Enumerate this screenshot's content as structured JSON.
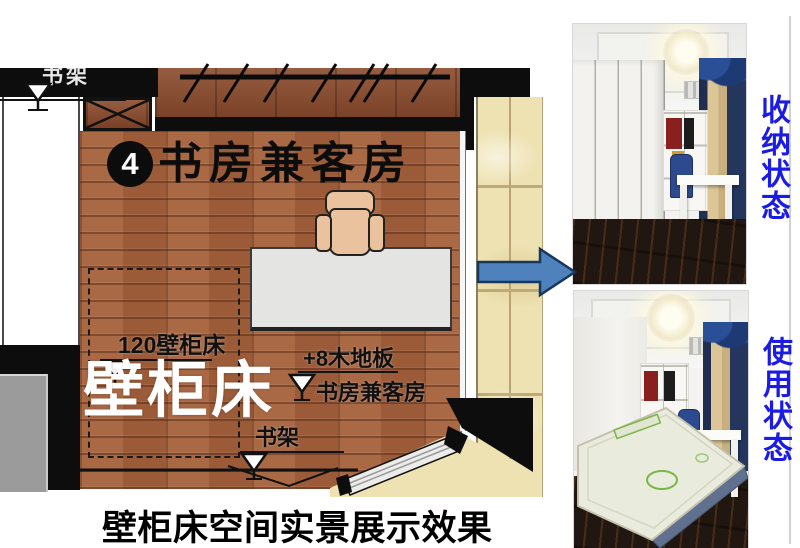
{
  "plan": {
    "unit_number": "4",
    "room_title": "书房兼客房",
    "top_shelf_label": "书架",
    "bed_width_label": "120壁柜床",
    "bed_name_label": "壁柜床",
    "floor_height_label": "+8木地板",
    "room_floor_label": "书房兼客房",
    "bottom_shelf_label": "书架"
  },
  "caption": "壁柜床空间实景展示效果",
  "photos": {
    "storage": {
      "label": "收纳状态"
    },
    "in_use": {
      "label": "使用状态"
    }
  },
  "colors": {
    "wood_floor": "#a6613b",
    "wardrobe_wood": "#8a4a2c",
    "tile": "#eee2b2",
    "desk": "#e4e4e2",
    "chair": "#eac29e",
    "wall_black": "#0d0d0d",
    "arrow_fill": "#4f81bd",
    "arrow_border": "#17375e",
    "photo_label": "#1b1be6"
  }
}
